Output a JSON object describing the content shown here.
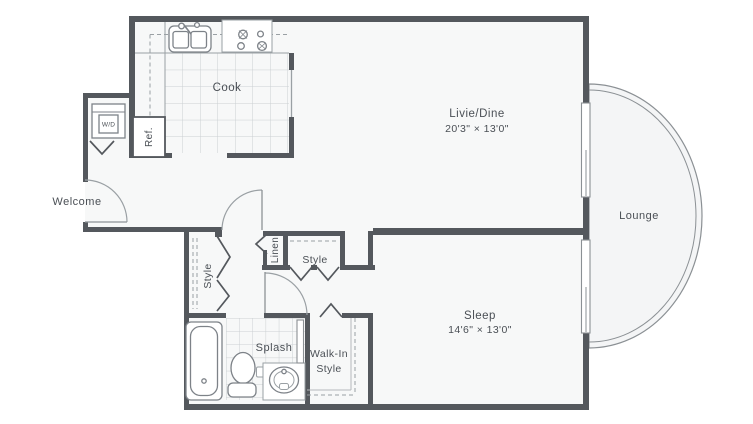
{
  "plan": {
    "rooms": {
      "cook": {
        "label": "Cook"
      },
      "livie_dine": {
        "label": "Livie/Dine",
        "dimensions": "20'3\" × 13'0\""
      },
      "lounge": {
        "label": "Lounge"
      },
      "welcome": {
        "label": "Welcome"
      },
      "sleep": {
        "label": "Sleep",
        "dimensions": "14'6\" × 13'0\""
      },
      "splash": {
        "label": "Splash"
      },
      "walk_in": {
        "line1": "Walk-In",
        "line2": "Style"
      },
      "style_left": {
        "label": "Style"
      },
      "style_right": {
        "label": "Style"
      },
      "linen": {
        "label": "Linen"
      }
    },
    "appliances": {
      "refrigerator": {
        "label": "Ref."
      },
      "washer_dryer": {
        "label": "W/D"
      }
    },
    "colors": {
      "wall": "#54585d",
      "fixture_line": "#7d8288",
      "light_line": "#9aa0a4",
      "tile_line": "#cbcfd2",
      "text": "#4a4f55",
      "floor": "#f7f8f8",
      "background": "#ffffff"
    }
  }
}
